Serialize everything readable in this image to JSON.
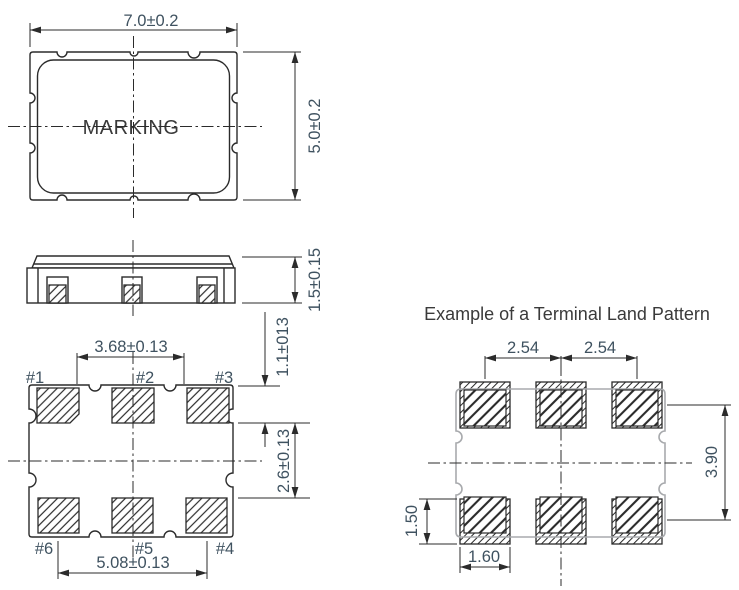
{
  "top_view": {
    "marking": "MARKING",
    "width_dim": "7.0±0.2",
    "height_dim": "5.0±0.2"
  },
  "side_view": {
    "thickness_dim": "1.5±0.15"
  },
  "bottom_view": {
    "labels": {
      "p1": "#1",
      "p2": "#2",
      "p3": "#3",
      "p4": "#4",
      "p5": "#5",
      "p6": "#6"
    },
    "dims": {
      "inner_pad_span": "3.68±0.13",
      "outer_pad_span": "5.08±0.13",
      "row_gap": "2.6±0.13",
      "edge_offset": "1.1±013"
    }
  },
  "land_pattern": {
    "title": "Example of a Terminal Land Pattern",
    "dims": {
      "pitch_left": "2.54",
      "pitch_right": "2.54",
      "row_pitch": "3.90",
      "pad_height": "1.50",
      "pad_width": "1.60"
    }
  },
  "colors": {
    "drawing_line": "#2b2b2b",
    "dimension_text": "#3f5260",
    "heading_text": "#3a3a3a",
    "land_outline_gray": "#a8aaad"
  }
}
